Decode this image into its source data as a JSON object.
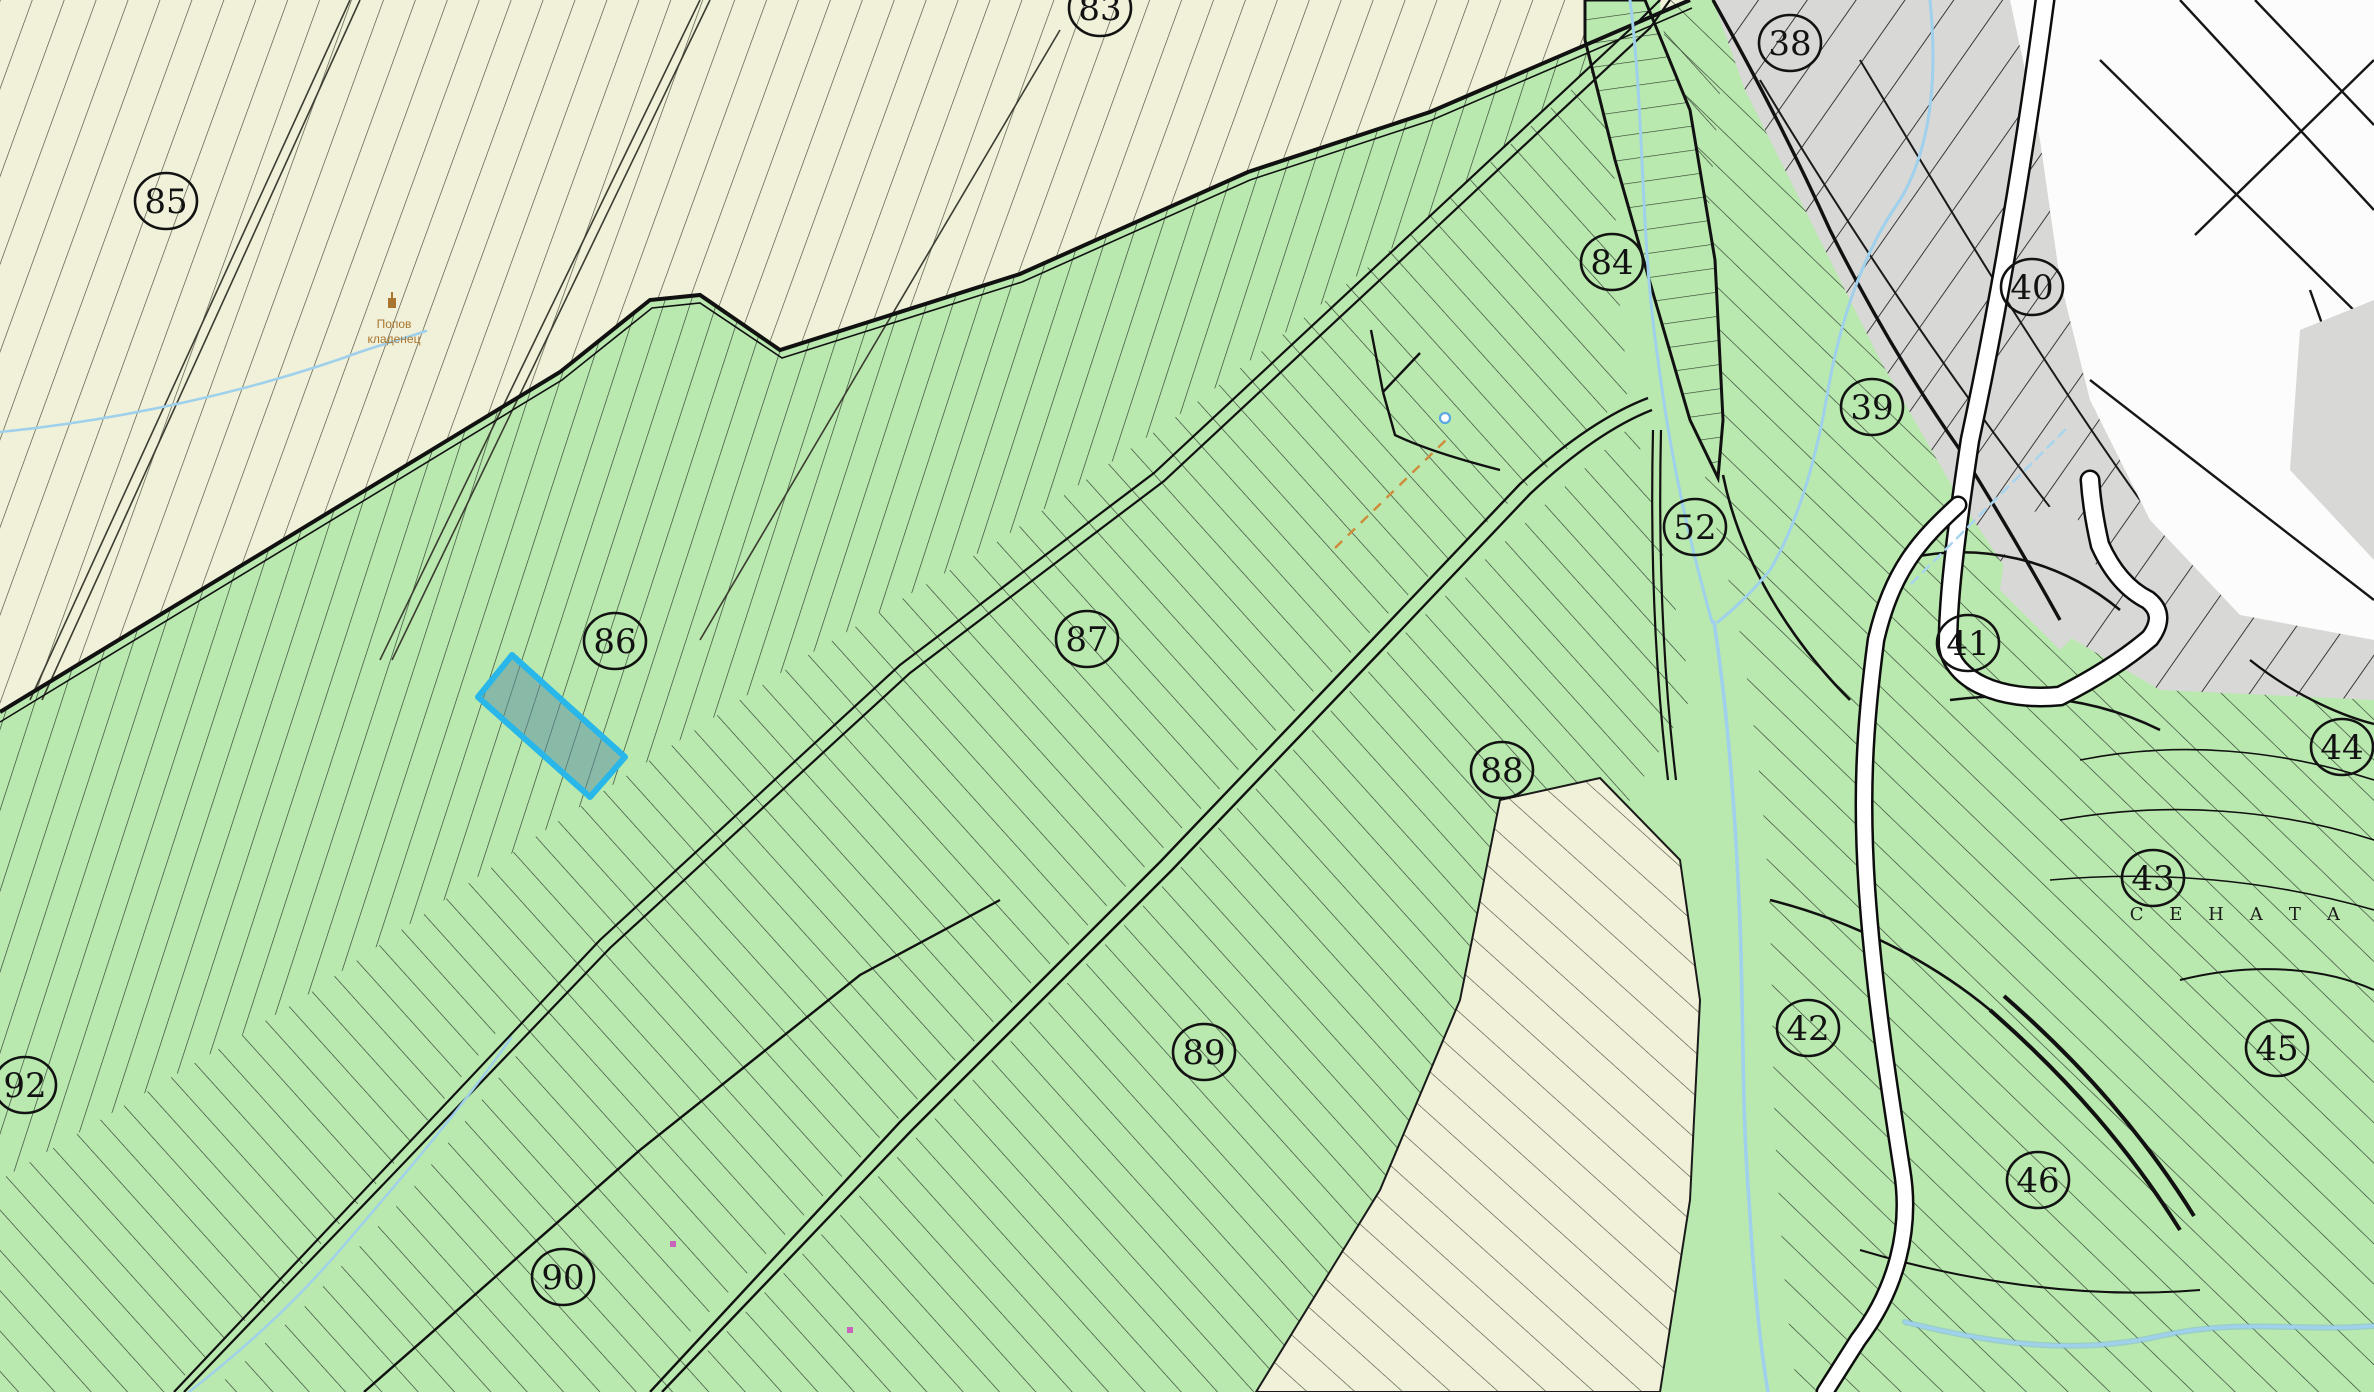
{
  "map": {
    "title": "cadastral-parcel-map",
    "region_colors": {
      "field_beige": "#f0f1d8",
      "agr_green": "#b9e9ae",
      "urban_gray": "#d8d8d6",
      "regulation_white": "#fcfcfc",
      "boundary_black": "#111111",
      "stream_blue": "#9fd0ec",
      "highlight_cyan": "#29b7ea",
      "pipeline_orange": "#cf8a3a",
      "well_brown": "#a87430"
    },
    "parcel_labels": [
      {
        "label": "83",
        "x": 1100,
        "y": 8
      },
      {
        "label": "85",
        "x": 166,
        "y": 201
      },
      {
        "label": "86",
        "x": 615,
        "y": 641
      },
      {
        "label": "87",
        "x": 1087,
        "y": 639
      },
      {
        "label": "88",
        "x": 1502,
        "y": 770
      },
      {
        "label": "89",
        "x": 1204,
        "y": 1052
      },
      {
        "label": "90",
        "x": 563,
        "y": 1277
      },
      {
        "label": "92",
        "x": 25,
        "y": 1085
      },
      {
        "label": "84",
        "x": 1612,
        "y": 262
      },
      {
        "label": "38",
        "x": 1790,
        "y": 43
      },
      {
        "label": "39",
        "x": 1872,
        "y": 407
      },
      {
        "label": "40",
        "x": 2032,
        "y": 287
      },
      {
        "label": "41",
        "x": 1968,
        "y": 643
      },
      {
        "label": "42",
        "x": 1808,
        "y": 1028
      },
      {
        "label": "43",
        "x": 2153,
        "y": 878
      },
      {
        "label": "44",
        "x": 2342,
        "y": 747
      },
      {
        "label": "45",
        "x": 2277,
        "y": 1048
      },
      {
        "label": "46",
        "x": 2038,
        "y": 1180
      },
      {
        "label": "52",
        "x": 1695,
        "y": 527
      }
    ],
    "locality_label": {
      "text": "С Е Н А Т А",
      "x": 2240,
      "y": 920
    },
    "well_label": {
      "line1": "Попов",
      "line2": "кладенец",
      "x": 394,
      "y1": 328,
      "y2": 343
    },
    "highlighted_parcel": {
      "points": "512,655 478,697 590,797 625,757",
      "stroke": "#29b7ea",
      "fill": "rgba(90,140,160,0.5)"
    }
  }
}
